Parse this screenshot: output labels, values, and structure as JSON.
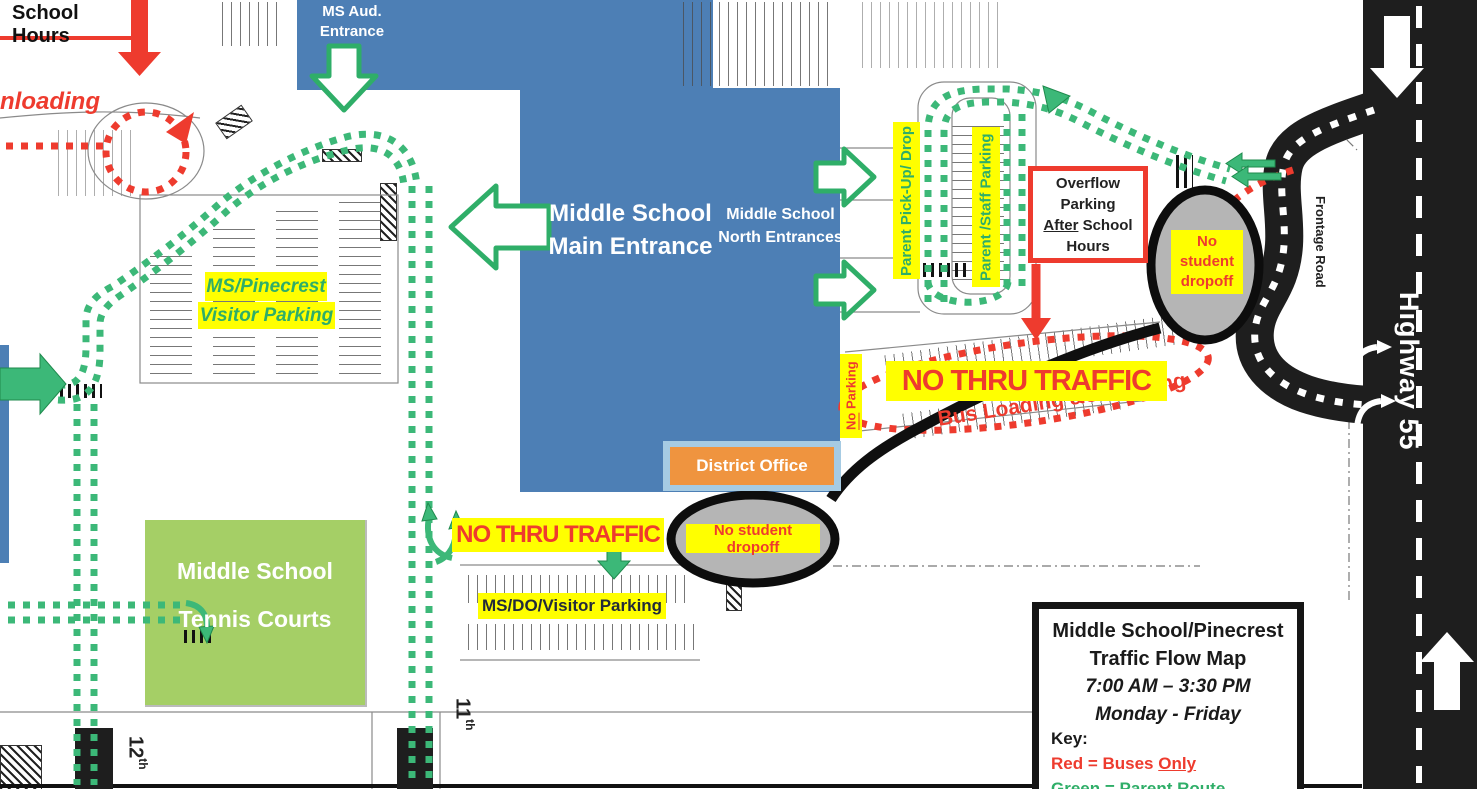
{
  "colors": {
    "building_blue": "#4d7fb5",
    "route_green": "#3cb878",
    "bus_red": "#ee3b2e",
    "highlight_yellow": "#ffff00",
    "tennis_green": "#a5cf66",
    "district_orange": "#ef943f",
    "district_border_blue": "#a6cbe3",
    "road_black": "#1e1e1e",
    "dropoff_gray": "#b5b5b5"
  },
  "labels": {
    "school_hours": "School Hours",
    "unloading": "nloading",
    "ms_aud_entrance": {
      "line1": "MS Aud.",
      "line2": "Entrance"
    },
    "main_entrance": {
      "line1": "Middle School",
      "line2": "Main Entrance"
    },
    "north_entrances": {
      "line1": "Middle School",
      "line2": "North Entrances"
    },
    "visitor_parking": {
      "line1": "MS/Pinecrest",
      "line2": "Visitor Parking"
    },
    "parent_pickup": "Parent Pick-Up/ Drop",
    "parent_staff": "Parent /Staff Parking",
    "overflow": {
      "line1": "Overflow",
      "line2": "Parking",
      "line3_underline": "After",
      "line3_rest": " School",
      "line4": "Hours"
    },
    "no_student_dropoff_upper": {
      "line1": "No",
      "line2": "student",
      "line3": "dropoff"
    },
    "no_student_dropoff_lower": "No student dropoff",
    "no_thru_traffic_upper": "NO THRU TRAFFIC",
    "no_thru_traffic_lower": "NO THRU TRAFFIC",
    "bus_loading": "Bus Loading &Unloading",
    "no_parking": {
      "underline": "No",
      "rest": " Parking"
    },
    "district_office": "District Office",
    "tennis_courts": {
      "line1": "Middle School",
      "line2": "Tennis Courts"
    },
    "ms_do_visitor_parking": "MS/DO/Visitor Parking",
    "street_12th": {
      "num": "12",
      "sup": "th"
    },
    "street_11th": {
      "num": "11",
      "sup": "th"
    },
    "frontage_road": "Frontage Road",
    "highway_55": "Highway 55"
  },
  "legend": {
    "title_line1": "Middle School/Pinecrest",
    "title_line2": "Traffic Flow Map",
    "hours": "7:00 AM – 3:30 PM",
    "days": "Monday - Friday",
    "key_label": "Key:",
    "red_key_pre": "Red = Buses ",
    "red_key_underline": "Only",
    "green_key": "Green = Parent Route"
  },
  "icons": {
    "green_entrance_arrows": "entrance-arrow",
    "red_bus_route": "bus-route-dots",
    "green_parent_route": "parent-route-dots",
    "highway_down_arrow": "down-arrow",
    "highway_up_arrow": "up-arrow",
    "turn_arrows": "right-turn-arrow"
  }
}
